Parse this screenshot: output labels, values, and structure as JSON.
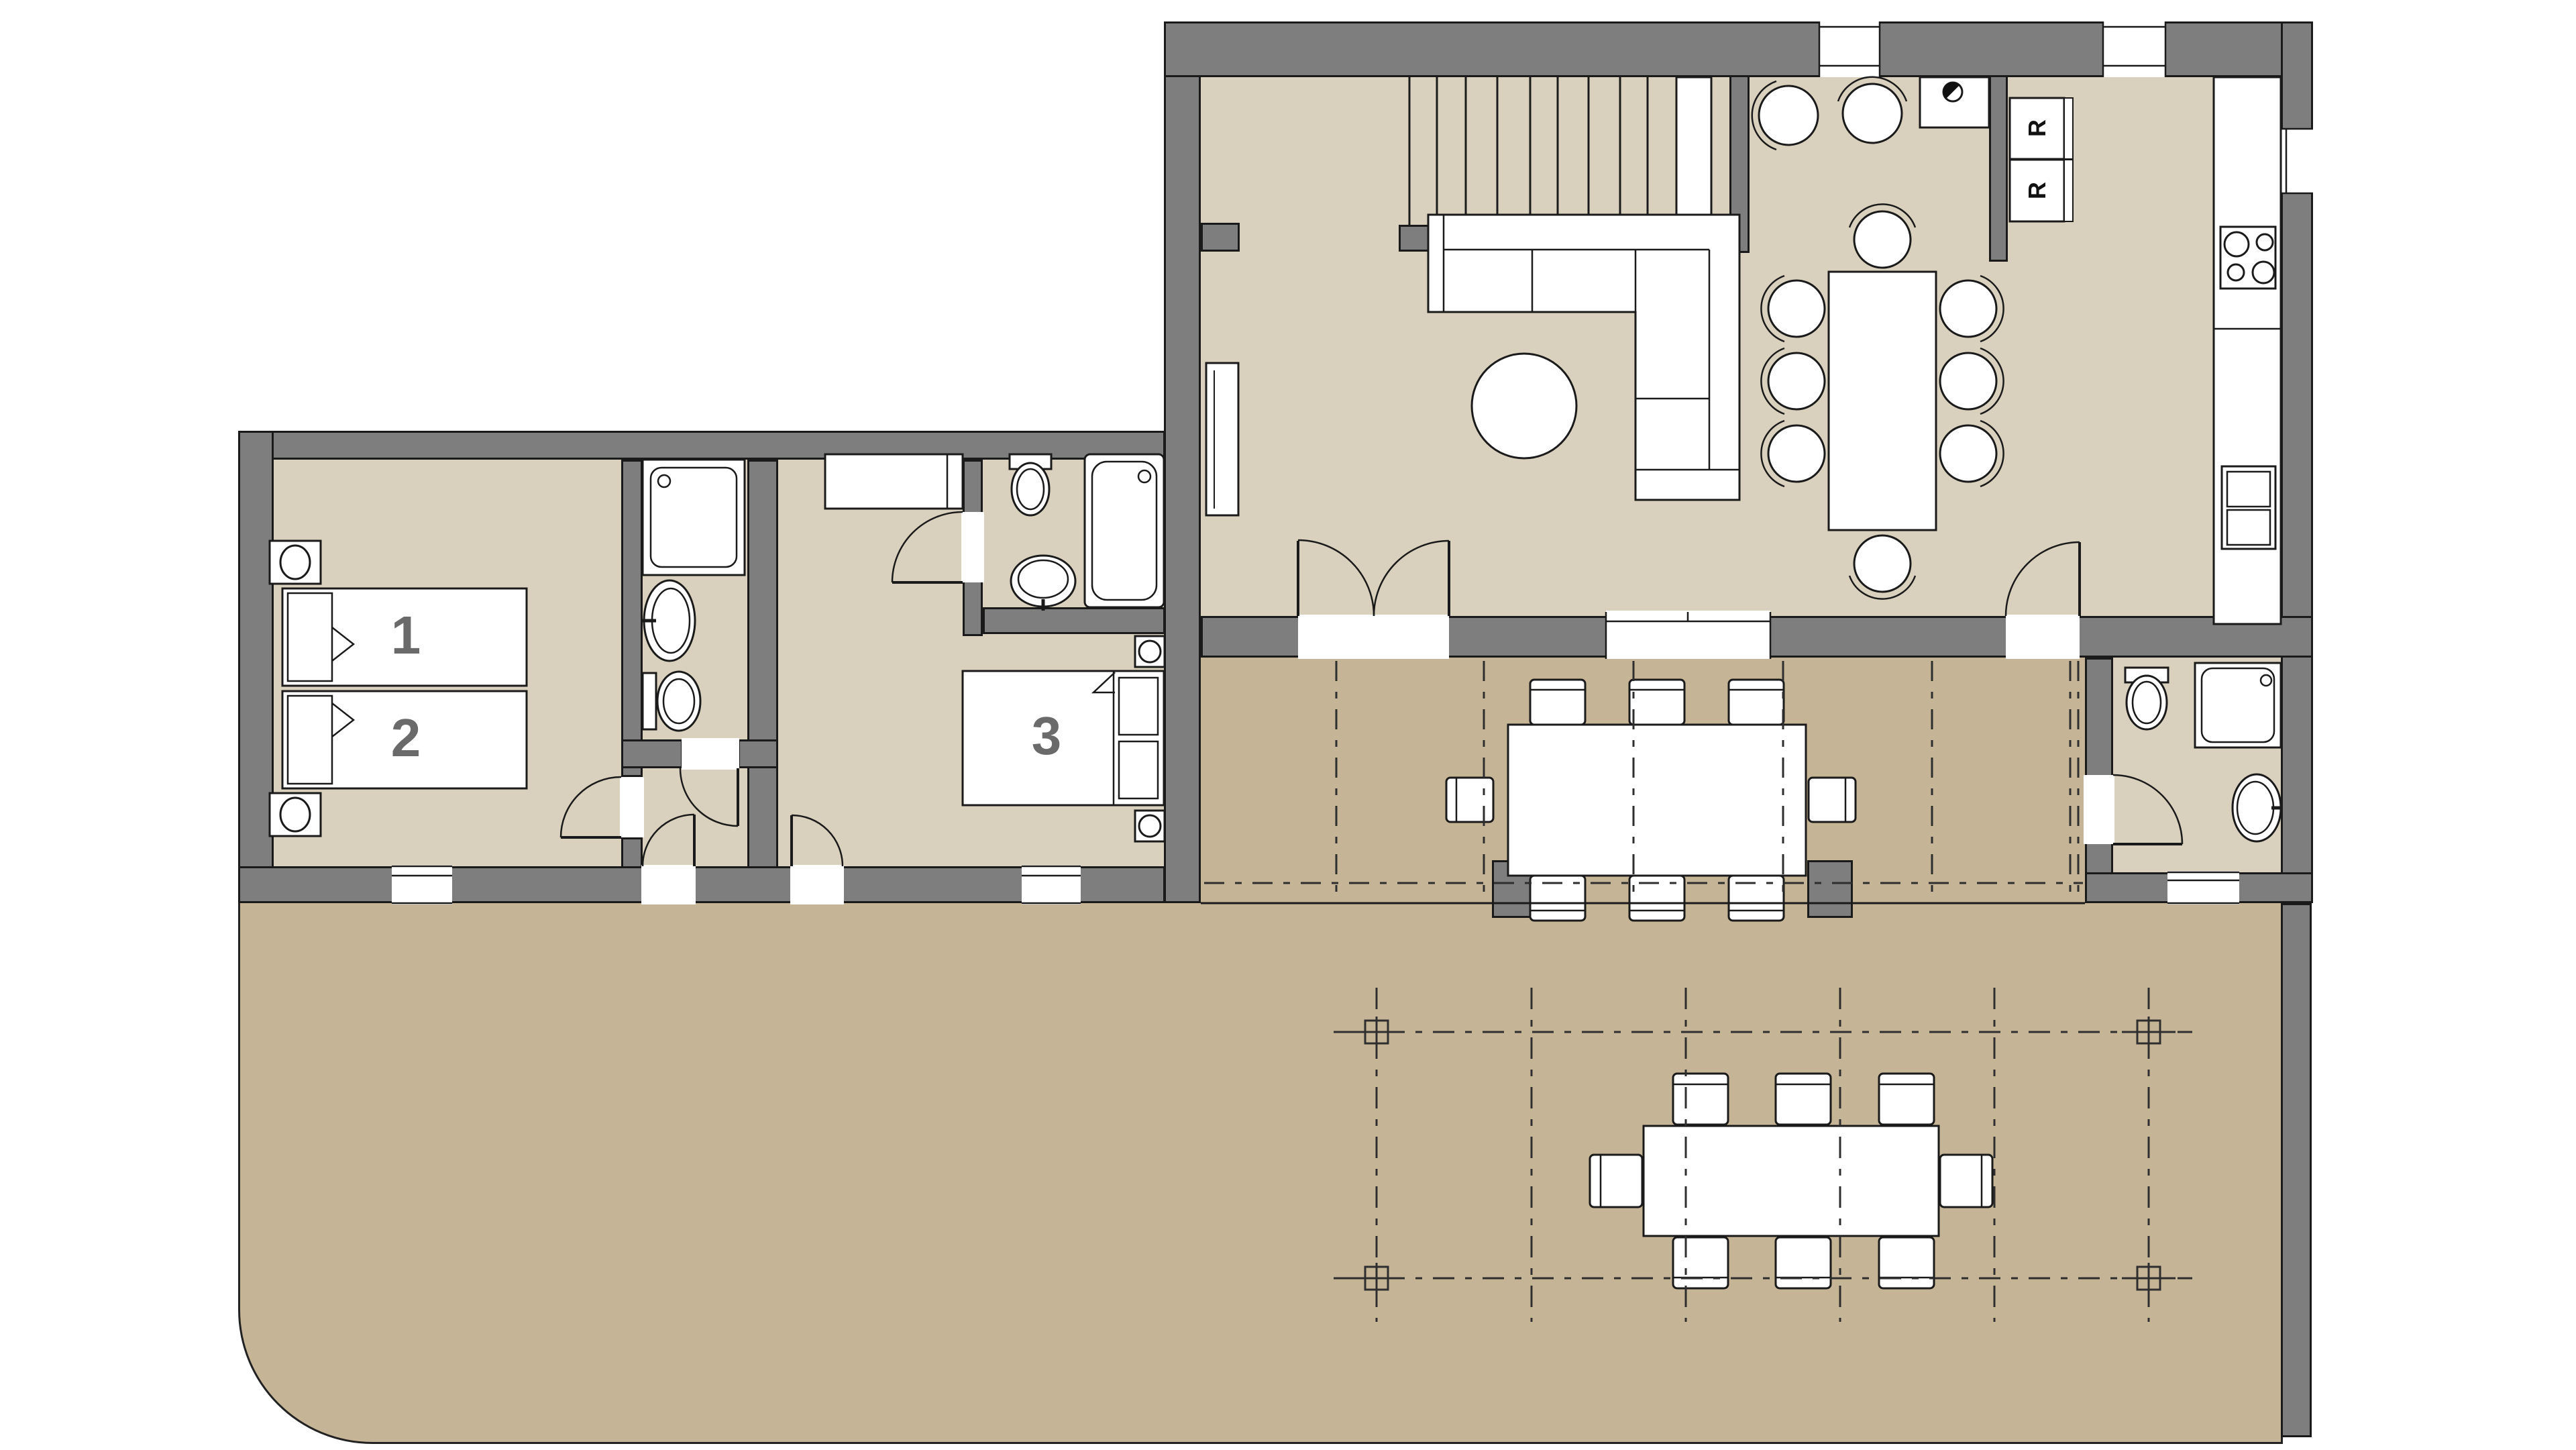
{
  "plan": {
    "type": "residential-floor-plan",
    "labels": {
      "bed1": "1",
      "bed2": "2",
      "bed3": "3",
      "fridge_top": "R",
      "fridge_bottom": "R"
    },
    "colors": {
      "wall_fill": "#7e7e7e",
      "wall_outline": "#1a1a1a",
      "interior_floor": "#d9d1bd",
      "terrace_floor": "#c6b496",
      "fixture_fill": "#ffffff",
      "room_label": "#6a6a6a",
      "pergola_line": "#2e2e2e"
    },
    "icons": [
      "stairs-icon",
      "sofa-icon",
      "coffee-table-icon",
      "dining-table-icon",
      "chair-icon",
      "sink-icon",
      "cooktop-icon",
      "oven-icon",
      "refrigerator-icon",
      "bed-icon",
      "nightstand-icon",
      "wardrobe-icon",
      "toilet-icon",
      "shower-icon",
      "bathtub-icon",
      "door-swing-icon",
      "window-icon",
      "pergola-post-icon",
      "outdoor-table-icon"
    ]
  }
}
